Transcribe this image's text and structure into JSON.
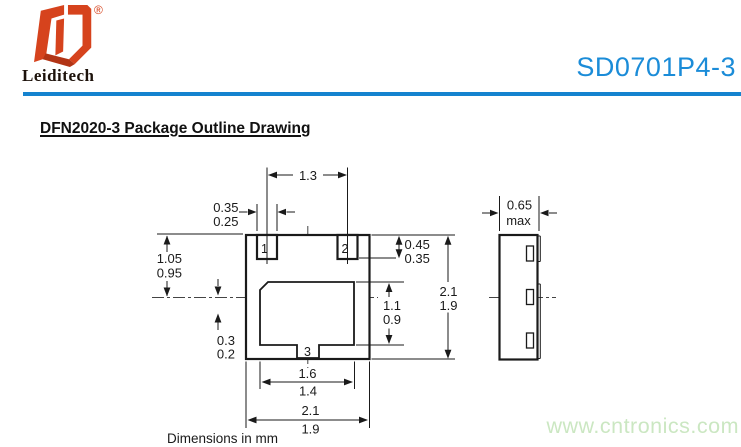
{
  "header": {
    "brand": "Leiditech",
    "registered_mark": "®",
    "part_number": "SD0701P4-3"
  },
  "section_title": "DFN2020-3 Package Outline Drawing",
  "drawing": {
    "pins": {
      "pin1": "1",
      "pin2": "2",
      "pin3": "3"
    },
    "dimensions": {
      "pad_pitch": "1.3",
      "pad_width_max": "0.35",
      "pad_width_min": "0.25",
      "pad_depth_max": "0.45",
      "pad_depth_min": "0.35",
      "top_to_center_max": "1.05",
      "top_to_center_min": "0.95",
      "center_offset_max": "0.3",
      "center_offset_min": "0.2",
      "epad_length_max": "1.1",
      "epad_length_min": "0.9",
      "body_length_max": "2.1",
      "body_length_min": "1.9",
      "epad_width_max": "1.6",
      "epad_width_min": "1.4",
      "body_width_max": "2.1",
      "body_width_min": "1.9",
      "thickness_value": "0.65",
      "thickness_qualifier": "max"
    },
    "units_note": "Dimensions in mm"
  },
  "watermark": "www.cntronics.com",
  "colors": {
    "accent_blue": "#1b8cd8",
    "bar_blue": "#1583cf",
    "logo_red": "#d6431d",
    "logo_red_dark": "#b23415",
    "watermark_green": "#cbe7c2",
    "line_black": "#1a1a1a"
  }
}
